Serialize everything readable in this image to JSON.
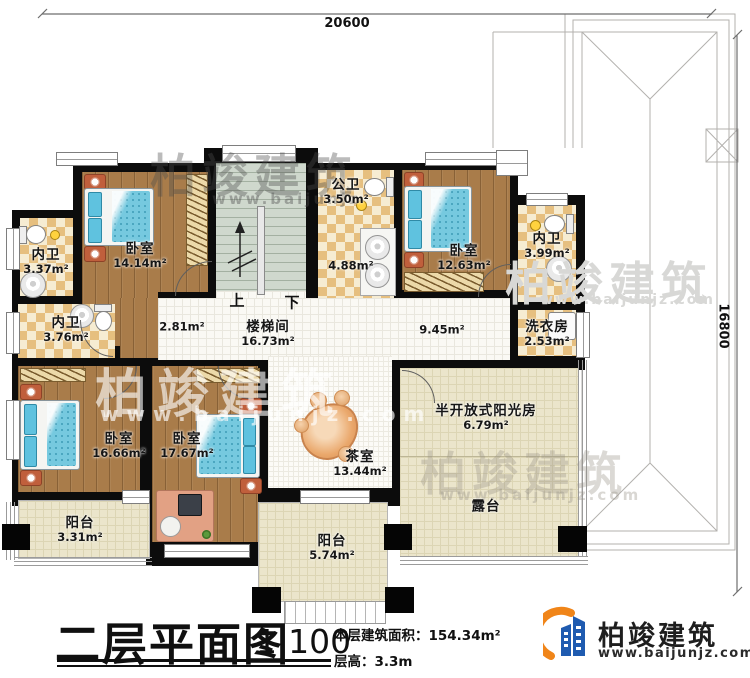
{
  "dimensions": {
    "top": "20600",
    "right": "16800"
  },
  "stair_labels": {
    "up": "上",
    "down": "下"
  },
  "rooms": [
    {
      "name": "内卫",
      "area": "3.37m²"
    },
    {
      "name": "卧室",
      "area": "14.14m²"
    },
    {
      "name": "公卫",
      "area": "3.50m²"
    },
    {
      "name": "",
      "area": "4.88m²"
    },
    {
      "name": "卧室",
      "area": "12.63m²"
    },
    {
      "name": "内卫",
      "area": "3.99m²"
    },
    {
      "name": "内卫",
      "area": "3.76m²"
    },
    {
      "name": "",
      "area": "2.81m²"
    },
    {
      "name": "楼梯间",
      "area": "16.73m²"
    },
    {
      "name": "",
      "area": "9.45m²"
    },
    {
      "name": "洗衣房",
      "area": "2.53m²"
    },
    {
      "name": "卧室",
      "area": "16.66m²"
    },
    {
      "name": "卧室",
      "area": "17.67m²"
    },
    {
      "name": "茶室",
      "area": "13.44m²"
    },
    {
      "name": "半开放式阳光房",
      "area": "6.79m²"
    },
    {
      "name": "露台",
      "area": ""
    },
    {
      "name": "阳台",
      "area": "3.31m²"
    },
    {
      "name": "阳台",
      "area": "5.74m²"
    }
  ],
  "title_block": {
    "title": "二层平面图",
    "scale": "1:100",
    "area_label": "本层建筑面积：",
    "area_value": "154.34m²",
    "height_label": "层高：",
    "height_value": "3.3m"
  },
  "logo": {
    "name": "柏竣建筑",
    "url": "www.baijunjz.com"
  },
  "watermark": {
    "text": "柏竣建筑",
    "url": "www.baijunjz.com",
    "url_short": "www.baijunjz"
  },
  "colors": {
    "wall": "#0c0c0c",
    "wood_floor": "#a97c4a",
    "tile_dark": "#e6bf7f",
    "tile_light": "#f6ecd2",
    "stair": "#cfd8cd",
    "terrace": "#ebe5cb",
    "bed_blue": "#76c9df",
    "logo_blue": "#1f5bb0",
    "logo_orange": "#f08519"
  }
}
